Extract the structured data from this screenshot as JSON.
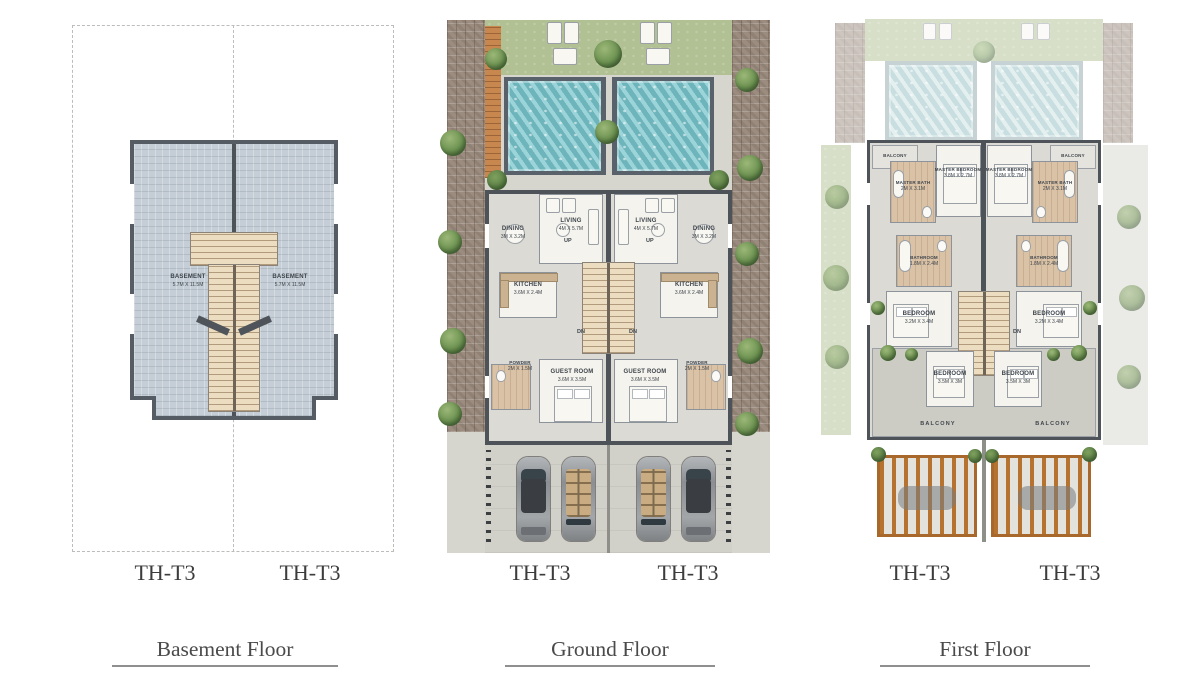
{
  "colors": {
    "pool_water": "#8accd2",
    "lawn": "#b2c194",
    "wood_deck": "#c8874f",
    "wall": "#4d5359",
    "basement_floor": "#c5ced6",
    "paving": "#9c8c7f",
    "driveway": "#d2d1c9",
    "stair_tread": "#ecdcc0",
    "bath_floor": "#d9c2a6",
    "title_text": "#4a4a4a"
  },
  "floors": [
    {
      "id": "basement",
      "title": "Basement Floor",
      "units": [
        "TH-T3",
        "TH-T3"
      ],
      "rooms": {
        "basement": {
          "name": "BASEMENT",
          "dim": "5.7M X 11.5M"
        }
      }
    },
    {
      "id": "ground",
      "title": "Ground Floor",
      "units": [
        "TH-T3",
        "TH-T3"
      ],
      "rooms": {
        "living": {
          "name": "LIVING",
          "dim": "4M X 5.7M"
        },
        "dining": {
          "name": "DINING",
          "dim": "3M X 3.2M"
        },
        "kitchen": {
          "name": "KITCHEN",
          "dim": "3.6M X 2.4M"
        },
        "guest": {
          "name": "GUEST ROOM",
          "dim": "3.6M X 3.5M"
        },
        "powder": {
          "name": "POWDER",
          "dim": "2M X 1.5M"
        }
      },
      "stairs": {
        "up": "UP",
        "down": "DN"
      }
    },
    {
      "id": "first",
      "title": "First Floor",
      "units": [
        "TH-T3",
        "TH-T3"
      ],
      "rooms": {
        "master_bedroom": {
          "name": "MASTER BEDROOM",
          "dim": "3.8M X 2.7M"
        },
        "master_bath": {
          "name": "MASTER BATH",
          "dim": "2M X 3.1M"
        },
        "bathroom": {
          "name": "BATHROOM",
          "dim": "1.8M X 2.4M"
        },
        "bedroom_a": {
          "name": "BEDROOM",
          "dim": "3.2M X 3.4M"
        },
        "bedroom_b": {
          "name": "BEDROOM",
          "dim": "3.5M X 3M"
        },
        "balcony_small": {
          "name": "BALCONY"
        },
        "balcony_large": {
          "name": "BALCONY"
        }
      },
      "stairs": {
        "down": "DN"
      }
    }
  ]
}
